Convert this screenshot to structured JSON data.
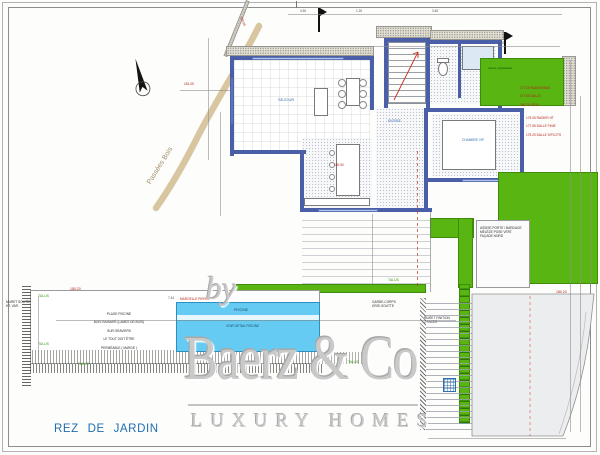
{
  "page": {
    "title": "REZ DE JARDIN"
  },
  "watermark": {
    "prefix": "by",
    "brand": "Baerz & Co",
    "tagline": "LUXURY HOMES"
  },
  "site": {
    "road_label": "Passées Bois",
    "talus_labels": [
      "TALUS",
      "TALUS",
      "TALUS",
      "TALUS",
      "TALUS"
    ],
    "green_note": "toiture végétalisée"
  },
  "rooms": {
    "sejour": "SEJOUR",
    "entree": "ENTREE",
    "chambre": "CHAMBRE VIP"
  },
  "pool": {
    "label": "PISCINE",
    "note": "VOIR DETAIL PISCINE",
    "edge_note": "MARGELLE PIERRE"
  },
  "terrace_note": {
    "l1": "PLAGE PISCINE",
    "l2": "BOIS RAINURÉ (LAMES DE BOIS)",
    "l3": "SUR GRAVIERS",
    "l4": "LE TOUT DOIT ÊTRE",
    "l5": "PERMÉABLE ( MARGE )"
  },
  "elevations": {
    "e1": "180.20",
    "e2": "180.20",
    "e3": "180.20",
    "e4": "180.50",
    "e5": "181.05",
    "e6": "180.85"
  },
  "annotations": {
    "red_list_1": [
      "177.05 RADIER/BAS",
      "177.55 DALLE",
      "180.70 SEUIL"
    ],
    "red_list_2": [
      "175.05 RADIER HT",
      "177.55 DALLE FINIE",
      "175.20 DALLE S/PLOTS"
    ],
    "muret_left": "MURET SOUTÈNEMENT\nHT. VAR.",
    "muret_right": "MURET FINITION\n2 FACES",
    "garde_corps_1": "GARDE-CORPS\nGRIS GOUTTE",
    "garde_corps_2": "GARDE-CORPS\nGRIS GOUTTE",
    "ramp_1": "RAMPE BÉTON DÉSACTIVÉ",
    "ramp_2": "ACCÈS GARAGE",
    "patio_note": "ASSISE PORTE / BARDAGE\nMÉLÈZE POSE VERT.\nFAÇADE NORD"
  },
  "dims": {
    "d1": "4.50",
    "d2": "1.20",
    "d3": "3.45",
    "d4": "2.80",
    "d5": "7.44",
    "d6": "4.02"
  }
}
